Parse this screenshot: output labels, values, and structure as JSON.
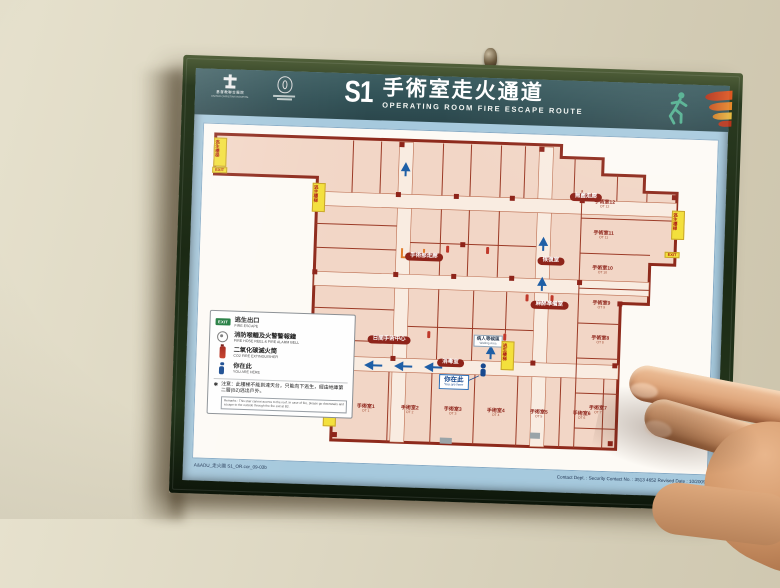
{
  "header": {
    "code": "S1",
    "title_zh": "手術室走火通道",
    "title_en": "OPERATING ROOM FIRE ESCAPE ROUTE",
    "hospital_zh": "基督教聯合醫院",
    "hospital_en": "UNITED CHRISTIAN HOSPITAL"
  },
  "legend": {
    "items": [
      {
        "icon": "exit-sign",
        "zh": "逃生出口",
        "en": "FIRE ESCAPE"
      },
      {
        "icon": "hose-reel",
        "zh": "消防喉轆及火警警報鐘",
        "en": "FIRE HOSE REEL & FIRE ALARM BELL"
      },
      {
        "icon": "co2-extinguisher",
        "zh": "二氧化碳滅火筒",
        "en": "CO2 FIRE EXTINGUISHER"
      },
      {
        "icon": "you-are-here",
        "zh": "你在此",
        "en": "YOU ARE HERE"
      }
    ],
    "note_mark": "✱",
    "note_zh": "注意：此樓梯不能到達天台，只能向下逃生，經由地庫第二層(B2)逃出戶外。",
    "note_en": "Remarks : This stair cannot access to the roof. In case of fire, please go downstairs and escape to the outside through the fire exit at B2."
  },
  "map": {
    "exit_tag": "逃生樓梯",
    "exit_box": "EXIT",
    "you_are_here": {
      "zh": "你在此",
      "en": "You are here"
    },
    "labels": [
      {
        "type": "lozenge",
        "x": 224,
        "y": 126,
        "zh": "手術部走廊"
      },
      {
        "type": "lozenge",
        "x": 384,
        "y": 61,
        "zh": "無菌走廊"
      },
      {
        "type": "lozenge",
        "x": 351,
        "y": 126,
        "zh": "恢復室"
      },
      {
        "type": "lozenge",
        "x": 351,
        "y": 170,
        "zh": "麻醉準備室"
      },
      {
        "type": "lozenge",
        "x": 192,
        "y": 210,
        "zh": "日間手術中心"
      },
      {
        "type": "lozenge",
        "x": 254,
        "y": 231,
        "zh": "消毒室"
      },
      {
        "type": "whitebox",
        "x": 291,
        "y": 208,
        "zh": "病人等候區",
        "en": "Waiting Area"
      },
      {
        "type": "room",
        "x": 403,
        "y": 68,
        "zh": "手術室12",
        "en": "OT 12"
      },
      {
        "type": "room",
        "x": 403,
        "y": 99,
        "zh": "手術室11",
        "en": "OT 11"
      },
      {
        "type": "room",
        "x": 403,
        "y": 134,
        "zh": "手術室10",
        "en": "OT 10"
      },
      {
        "type": "room",
        "x": 403,
        "y": 169,
        "zh": "手術室9",
        "en": "OT 9"
      },
      {
        "type": "room",
        "x": 403,
        "y": 204,
        "zh": "手術室8",
        "en": "OT 8"
      },
      {
        "type": "room",
        "x": 403,
        "y": 274,
        "zh": "手術室7",
        "en": "OT 7"
      },
      {
        "type": "room",
        "x": 171,
        "y": 280,
        "zh": "手術室1",
        "en": "OT 1"
      },
      {
        "type": "room",
        "x": 215,
        "y": 280,
        "zh": "手術室2",
        "en": "OT 2"
      },
      {
        "type": "room",
        "x": 258,
        "y": 280,
        "zh": "手術室3",
        "en": "OT 3"
      },
      {
        "type": "room",
        "x": 301,
        "y": 280,
        "zh": "手術室4",
        "en": "OT 4"
      },
      {
        "type": "room",
        "x": 344,
        "y": 280,
        "zh": "手術室5",
        "en": "OT 5"
      },
      {
        "type": "room",
        "x": 387,
        "y": 280,
        "zh": "手術室6",
        "en": "OT 6"
      }
    ],
    "ytags": [
      {
        "x": 17,
        "y": 28
      },
      {
        "x": 117,
        "y": 70
      },
      {
        "x": 135,
        "y": 284
      },
      {
        "x": 477,
        "y": 86
      },
      {
        "x": 311,
        "y": 222
      }
    ],
    "exitboxes": [
      {
        "x": 17,
        "y": 46
      },
      {
        "x": 472,
        "y": 116
      }
    ]
  },
  "footer": {
    "left": "A&ADU_走火圖 S1_OR.cor_09-03b",
    "right": "Contact Dept. : Security      Contact No. : 3513 4652      Revised Date : 10/2009"
  }
}
